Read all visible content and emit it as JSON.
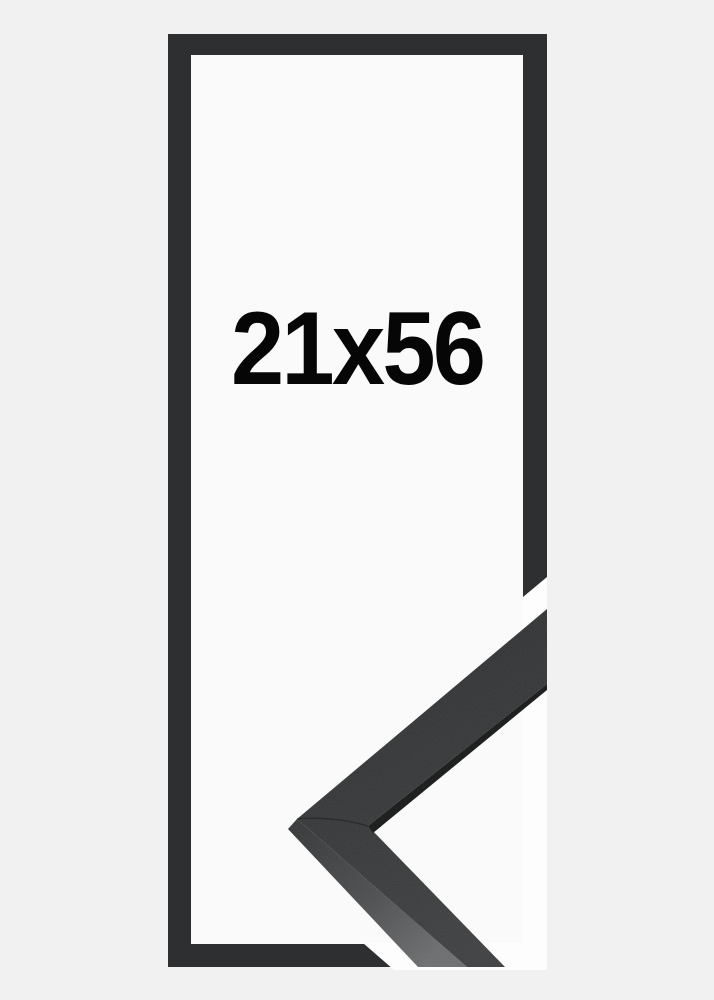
{
  "product": {
    "size_label": "21x56"
  },
  "colors": {
    "background": "#f1f1f2",
    "opening": "#fafafa",
    "gap_white": "#fdfdfd",
    "frame": "#2d2f30",
    "sample_face": "#343637",
    "sample_side": "#4c4e4f",
    "sample_edge": "#161717",
    "seam": "#1d1f20",
    "label": "#060606"
  }
}
